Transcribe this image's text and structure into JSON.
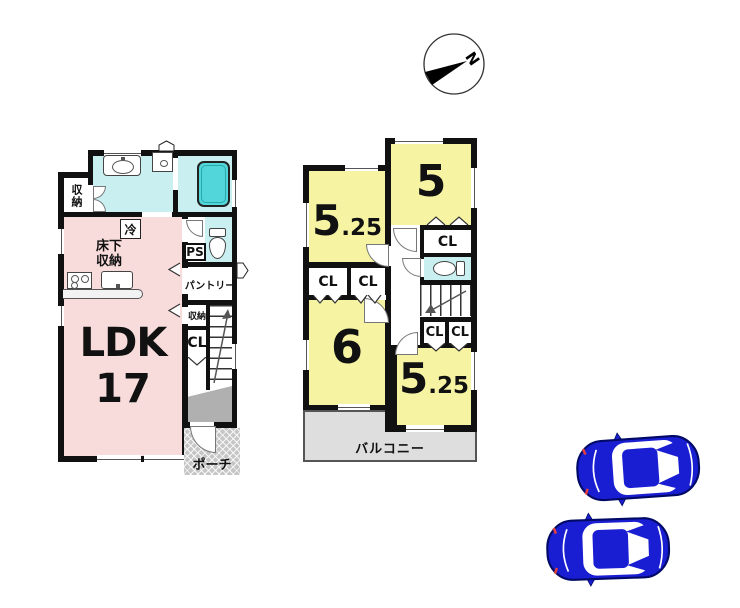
{
  "compass": {
    "north": "N"
  },
  "floor1": {
    "ldk_name": "LDK",
    "ldk_size": "17",
    "upper_left_closet": "収納",
    "fridge": "冷",
    "floor_storage_line1": "床下",
    "floor_storage_line2": "収納",
    "pipe_space": "PS",
    "pantry": "パントリー",
    "storage": "収納",
    "closet": "CL",
    "porch": "ポーチ"
  },
  "floor2": {
    "room_ne_num": "5",
    "room_nw_num": "5",
    "room_nw_frac": ".25",
    "room_sw_num": "6",
    "room_se_num": "5",
    "room_se_frac": ".25",
    "closets": [
      "CL",
      "CL",
      "CL",
      "CL",
      "CL"
    ],
    "balcony": "バルコニー"
  },
  "colors": {
    "room_pink": "#f8dbdb",
    "room_yellow": "#f6f4a2",
    "wet_area_cyan": "#c9eff1",
    "bathtub_teal": "#53d6d9",
    "balcony_gray": "#dedede",
    "entrance_gray": "#b0b0b0",
    "car_blue": "#1a1ed2",
    "wall_black": "#111111"
  }
}
